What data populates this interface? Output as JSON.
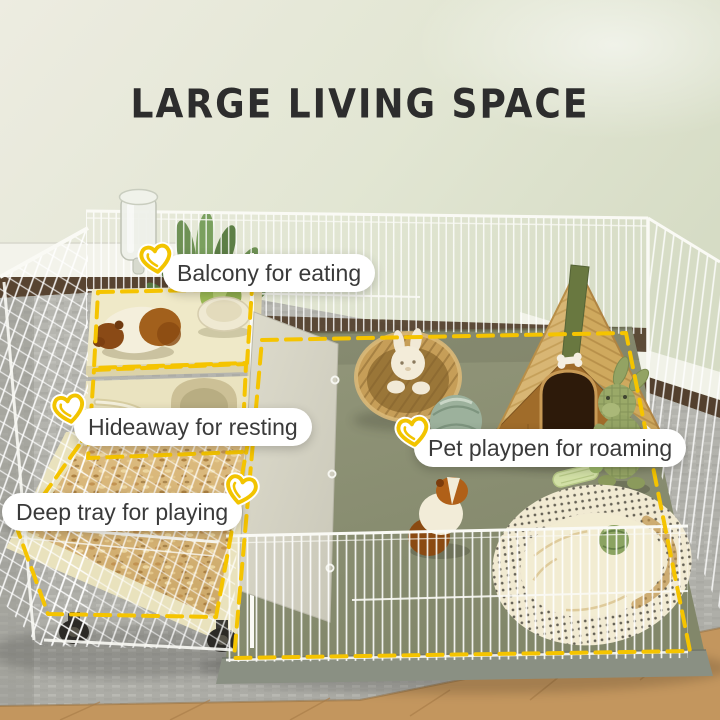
{
  "title": {
    "text": "LARGE LIVING SPACE"
  },
  "annotations": {
    "balcony": {
      "text": "Balcony for eating",
      "icon": "heart-doodle-icon"
    },
    "hideaway": {
      "text": "Hideaway for resting",
      "icon": "heart-doodle-icon"
    },
    "tray": {
      "text": "Deep tray for playing",
      "icon": "heart-doodle-icon"
    },
    "playpen": {
      "text": "Pet playpen for roaming",
      "icon": "heart-doodle-icon"
    }
  },
  "style": {
    "accent_yellow": "#F2C400",
    "outline_dash_color": "#F5C400",
    "title_color": "#2D2D2D",
    "label_bg": "#FFFFFF",
    "label_text": "#3A3A3A",
    "wall_color": "#E3E6D4",
    "mat_green": "#8C9178",
    "rug_gray": "#B3B3AD",
    "wood_floor": "#C3965E",
    "bedding_tan": "#D9B87C",
    "house_wood": "#A06C2A",
    "roof_wood": "#D8B674",
    "roof_stripe_green": "#697840"
  },
  "outlined_regions": [
    "balcony",
    "hideaway",
    "deep-tray",
    "playpen-floor"
  ],
  "scene_items": [
    "water-bottle",
    "potted-plant",
    "balcony-guinea-pig",
    "food-bowl-with-greens",
    "hideaway-ramp",
    "deep-tray-bedding",
    "caster-wheels",
    "felt-door-panel",
    "wire-mesh-cage",
    "wicker-basket",
    "white-plush-bunny",
    "wooden-pet-house",
    "bone-ornament",
    "green-plush-bunny",
    "yarn-ball",
    "celery-stick",
    "playpen-guinea-pig",
    "fabric-pet-bed",
    "green-felt-ball",
    "wire-playpen-fence"
  ]
}
